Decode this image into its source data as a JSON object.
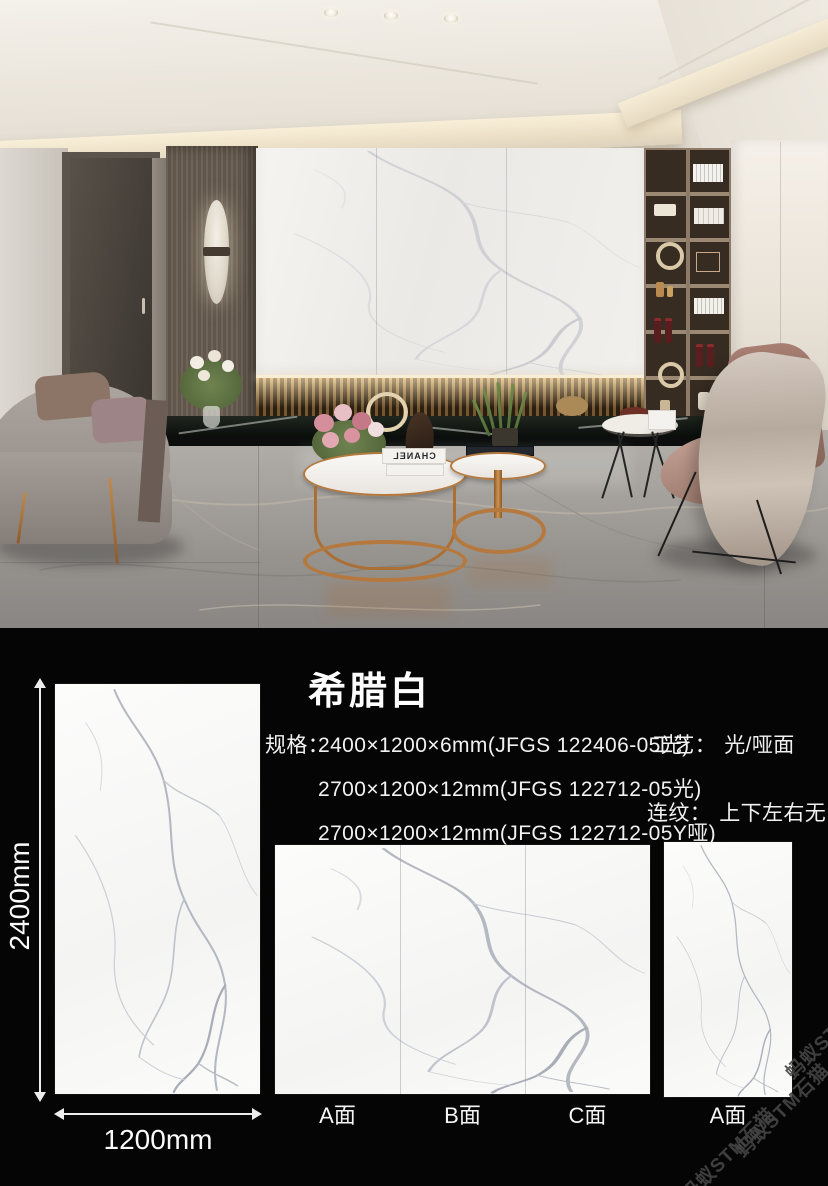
{
  "sheet": {
    "title": "希腊白",
    "spec_label": "规格：",
    "specs": [
      "2400×1200×6mm(JFGS 122406-05光)",
      "2700×1200×12mm(JFGS 122712-05光)",
      "2700×1200×12mm(JFGS 122712-05Y哑)"
    ],
    "craft_label": "工艺：",
    "craft_value": "光/哑面",
    "pattern_label": "连纹：",
    "pattern_value": "上下左右无限连纹",
    "height_dim": "2400mm",
    "width_dim": "1200mm",
    "panel_labels": [
      "A面",
      "B面",
      "C面"
    ],
    "right_panel_label": "A面",
    "watermark_text": "蚂蚁STM石猫"
  },
  "photo": {
    "book_brand": "CHANEL"
  },
  "colors": {
    "background": "#050505",
    "text": "#f1f1f1",
    "copper_accent": "#b5793f",
    "tile_white": "#fbfbfa",
    "watermark": "#454545"
  }
}
